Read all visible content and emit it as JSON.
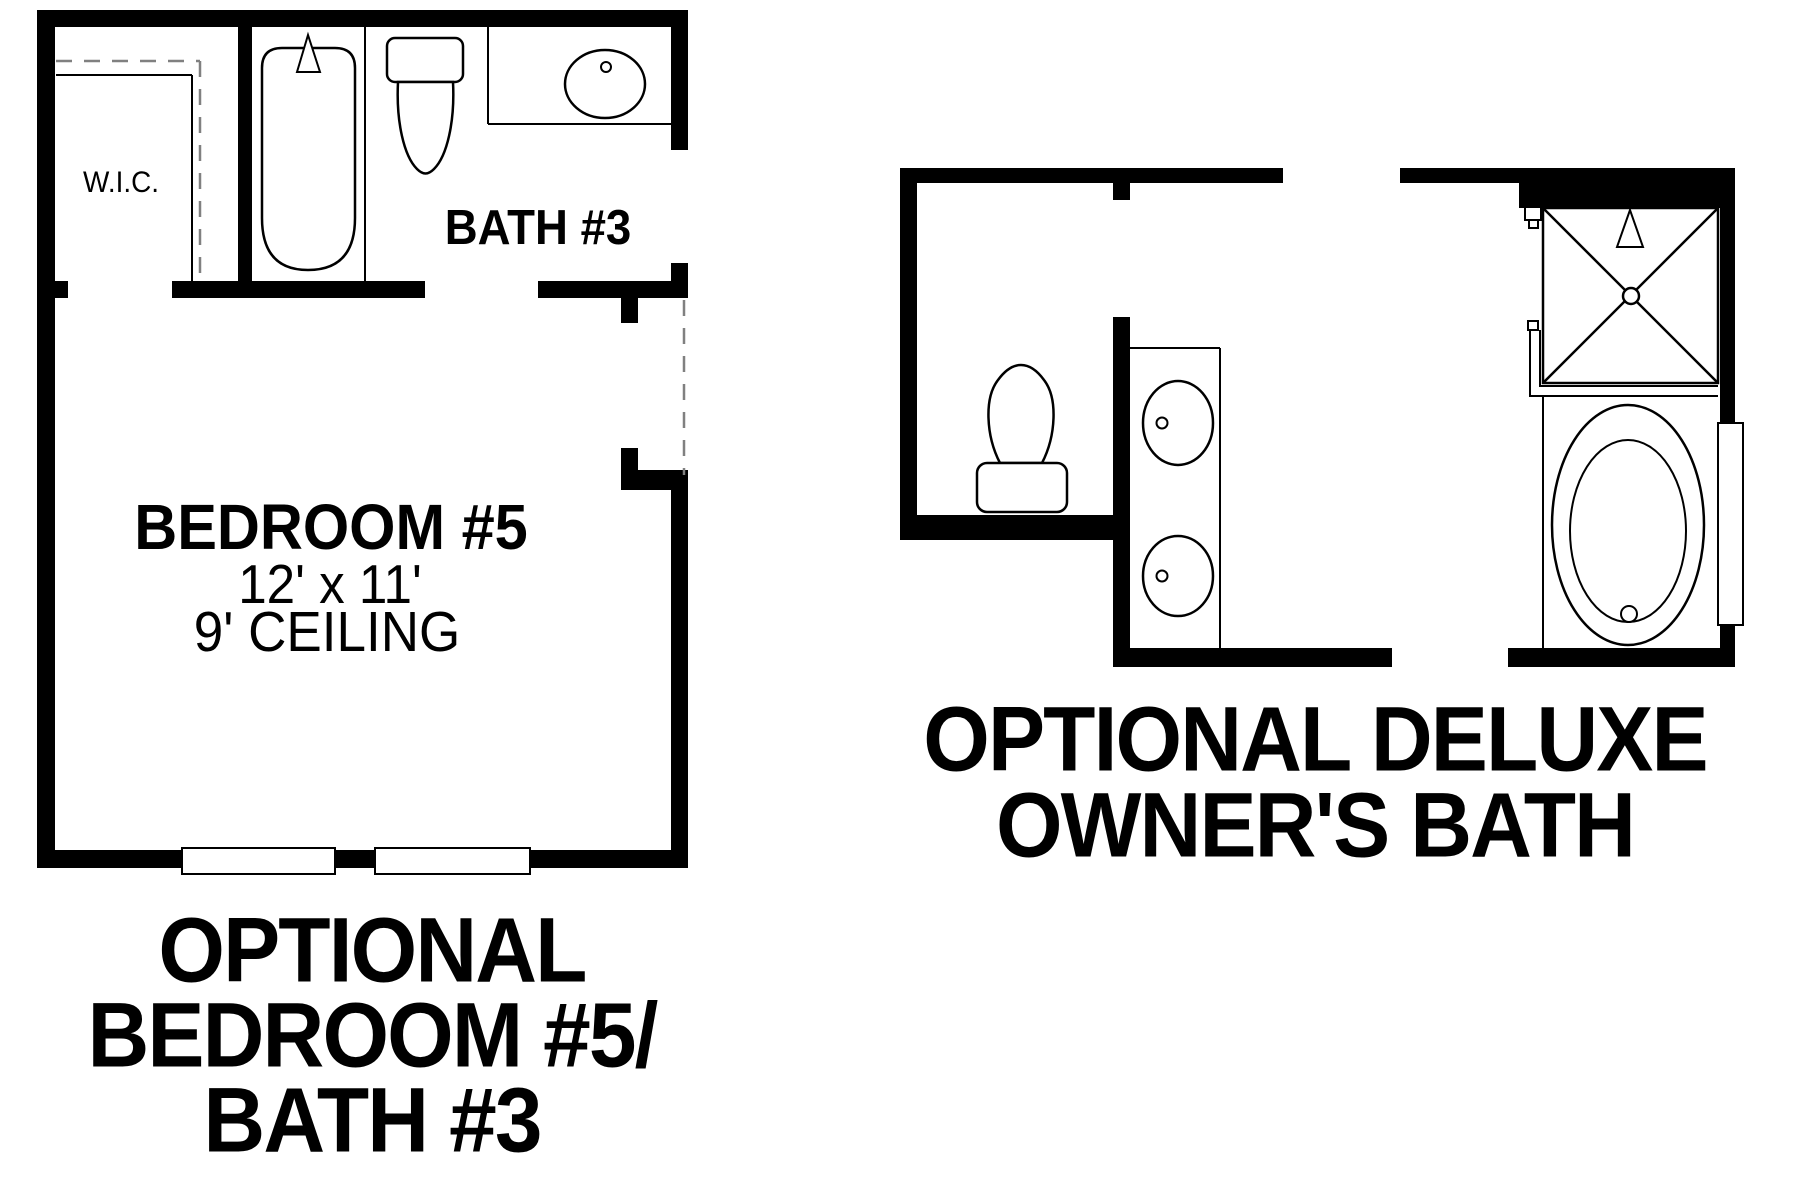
{
  "document": {
    "type": "floor-plan-options-sheet",
    "background_color": "#ffffff",
    "wall_color": "#000000",
    "dashed_line_color": "#808080"
  },
  "left_plan": {
    "wic_label": "W.I.C.",
    "bath_label": "BATH #3",
    "bedroom_label": "BEDROOM #5",
    "bedroom_dims": "12' x 11'",
    "bedroom_ceiling": "9' CEILING",
    "title_line1": "OPTIONAL",
    "title_line2": "BEDROOM #5/",
    "title_line3": "BATH #3",
    "fixtures": [
      "bathtub",
      "toilet",
      "sink-counter",
      "windows",
      "walk-in-closet"
    ]
  },
  "right_plan": {
    "title_line1": "OPTIONAL DELUXE",
    "title_line2": "OWNER'S BATH",
    "fixtures": [
      "toilet",
      "double-sink-vanity",
      "shower",
      "garden-tub",
      "window-ledge"
    ]
  }
}
